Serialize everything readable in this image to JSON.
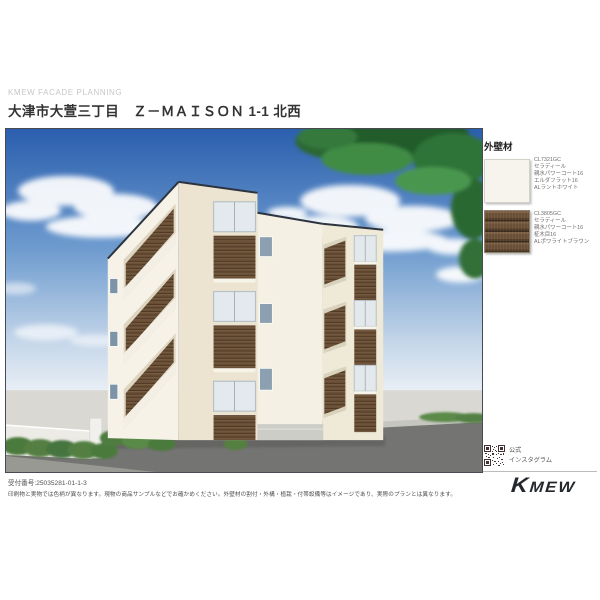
{
  "header": {
    "brand_line": "KMEW FACADE PLANNING",
    "title": "大津市大萱三丁目　Ｚ－ＭＡＩＳＯＮ 1-1 北西"
  },
  "materials_panel": {
    "heading": "外壁材",
    "items": [
      {
        "lines": [
          "CL7321GC",
          "セラディール",
          "親水パワーコート16",
          "エルダフラット16",
          "ALラントホワイト"
        ],
        "swatch_color": "#f6f4ec"
      },
      {
        "lines": [
          "CL3805GC",
          "セラディール",
          "親水パワーコート16",
          "柾木目16",
          "ALポワライトブラウン"
        ],
        "swatch_color": "#6a5036"
      }
    ],
    "instagram": {
      "line1": "公式",
      "line2": "インスタグラム"
    }
  },
  "footer": {
    "receipt_number": "受付番号:25035281-01-1-3",
    "disclaimer": "印刷物と実物では色柄が異なります。現物の商品サンプルなどでお確かめください。外壁材の割付・外構・植栽・付帯設備等はイメージであり、実際のプランとは異なります。",
    "logo_text": "Kmew"
  },
  "colors": {
    "sky_top": "#2b5fae",
    "sky_horizon": "#eef2f6",
    "wood": "#6a5036",
    "cream_wall": "#ece4d0",
    "road": "#747472",
    "logo": "#24282d"
  }
}
